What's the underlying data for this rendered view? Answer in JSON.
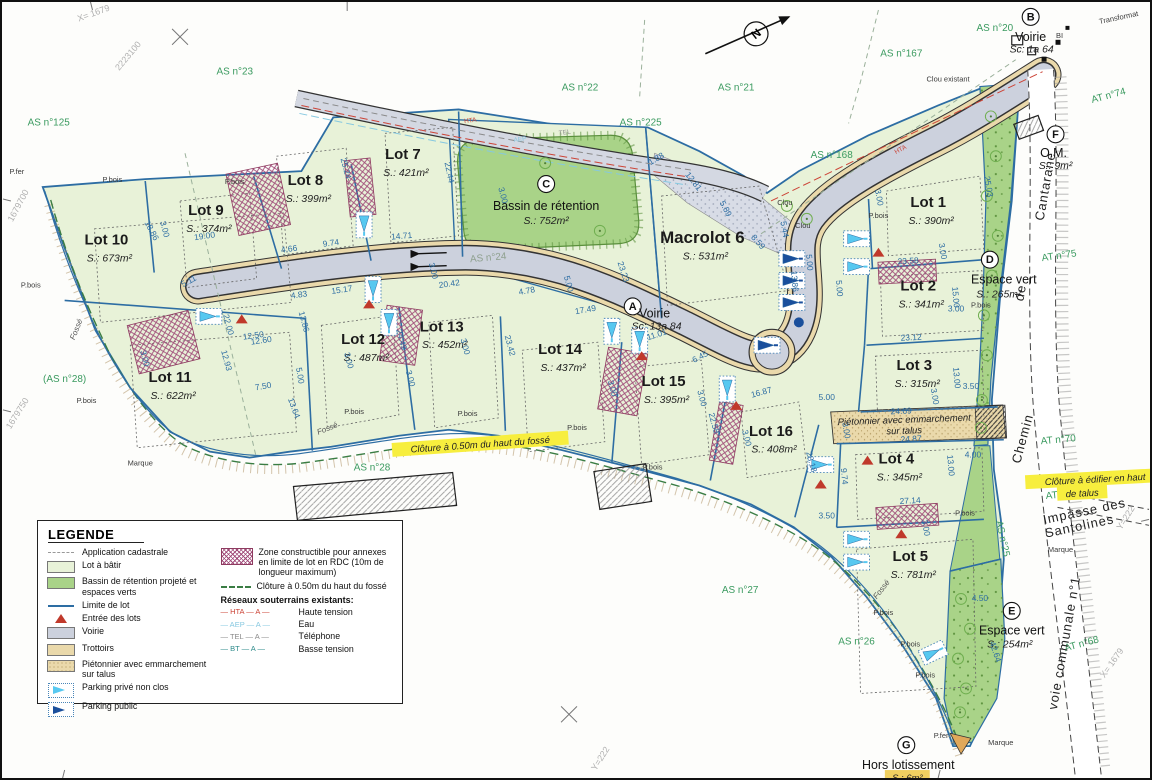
{
  "legend": {
    "title": "LEGENDE",
    "items": [
      {
        "key": "application-cadastrale",
        "swatch": "dash-gray",
        "label": "Application cadastrale"
      },
      {
        "key": "lot-a-batir",
        "swatch": "fill-lightgreen",
        "label": "Lot à bâtir"
      },
      {
        "key": "bassin-espaces-verts",
        "swatch": "fill-green",
        "label": "Bassin de rétention projeté et espaces verts"
      },
      {
        "key": "limite-de-lot",
        "swatch": "line-blue",
        "label": "Limite de lot"
      },
      {
        "key": "entree-des-lots",
        "swatch": "tri-red",
        "label": "Entrée des lots"
      },
      {
        "key": "voirie",
        "swatch": "fill-gray",
        "label": "Voirie"
      },
      {
        "key": "trottoirs",
        "swatch": "fill-tan",
        "label": "Trottoirs"
      },
      {
        "key": "pietonnier",
        "swatch": "fill-tantex",
        "label": "Piétonnier avec emmarchement sur talus"
      },
      {
        "key": "parking-prive",
        "swatch": "park-light",
        "label": "Parking privé non clos"
      },
      {
        "key": "parking-public",
        "swatch": "park-dark",
        "label": "Parking public"
      }
    ],
    "right_items": [
      {
        "key": "zone-constructible",
        "swatch": "hatch-purple",
        "label": "Zone constructible pour annexes en limite de lot en RDC (10m de longueur maximum)"
      },
      {
        "key": "cloture-fosse",
        "swatch": "dash-green",
        "label": "Clôture à 0.50m du haut du fossé"
      }
    ],
    "networks_title": "Réseaux souterrains existants:",
    "networks": [
      {
        "code": "HTA",
        "label": "Haute tension",
        "color": "#cc4437"
      },
      {
        "code": "AEP",
        "label": "Eau",
        "color": "#86c8e0"
      },
      {
        "code": "TEL",
        "label": "Téléphone",
        "color": "#8a8a8a"
      },
      {
        "code": "BT",
        "label": "Basse tension",
        "color": "#2e8b8b"
      }
    ]
  },
  "lots": [
    {
      "name": "Lot 1",
      "area": "S.: 390m²",
      "x": 930,
      "y": 206
    },
    {
      "name": "Lot 2",
      "area": "S.: 341m²",
      "x": 920,
      "y": 290
    },
    {
      "name": "Lot 3",
      "area": "S.: 315m²",
      "x": 916,
      "y": 370
    },
    {
      "name": "Lot 4",
      "area": "S.: 345m²",
      "x": 898,
      "y": 464
    },
    {
      "name": "Lot 5",
      "area": "S.: 781m²",
      "x": 912,
      "y": 562
    },
    {
      "name": "Macrolot 6",
      "area": "S.: 531m²",
      "x": 703,
      "y": 242,
      "big": true
    },
    {
      "name": "Lot 7",
      "area": "S.: 421m²",
      "x": 402,
      "y": 158
    },
    {
      "name": "Lot 8",
      "area": "S.: 399m²",
      "x": 304,
      "y": 184
    },
    {
      "name": "Lot 9",
      "area": "S.: 374m²",
      "x": 204,
      "y": 214
    },
    {
      "name": "Lot 10",
      "area": "S.: 673m²",
      "x": 104,
      "y": 244
    },
    {
      "name": "Lot 11",
      "area": "S.: 622m²",
      "x": 168,
      "y": 382
    },
    {
      "name": "Lot 12",
      "area": "S.: 487m²",
      "x": 362,
      "y": 344
    },
    {
      "name": "Lot 13",
      "area": "S.: 452m²",
      "x": 441,
      "y": 331
    },
    {
      "name": "Lot 14",
      "area": "S.: 437m²",
      "x": 560,
      "y": 354
    },
    {
      "name": "Lot 15",
      "area": "S.: 395m²",
      "x": 664,
      "y": 386
    },
    {
      "name": "Lot 16",
      "area": "S.: 408m²",
      "x": 772,
      "y": 436
    }
  ],
  "features": [
    {
      "letter": "A",
      "x": 633,
      "y": 306,
      "lines": [
        {
          "t": "Voirie",
          "dx": 22,
          "dy": 3,
          "cls": "t-feat"
        },
        {
          "t": "Sc: 13a 84",
          "dx": 24,
          "dy": 15,
          "cls": "t-area"
        }
      ]
    },
    {
      "letter": "B",
      "x": 1033,
      "y": 15,
      "lines": [
        {
          "t": "Voirie",
          "dx": 0,
          "dy": 16,
          "cls": "t-feat"
        },
        {
          "t": "Sc: 1a 64",
          "dx": 1,
          "dy": 28,
          "cls": "t-area"
        }
      ]
    },
    {
      "letter": "C",
      "x": 546,
      "y": 183,
      "lines": [
        {
          "t": "Bassin de rétention",
          "dx": 0,
          "dy": 18,
          "cls": "t-feat"
        },
        {
          "t": "S.: 752m²",
          "dx": 0,
          "dy": 32,
          "cls": "t-area"
        }
      ]
    },
    {
      "letter": "D",
      "x": 992,
      "y": 259,
      "lines": [
        {
          "t": "Espace vert",
          "dx": 14,
          "dy": 16,
          "cls": "t-feat"
        },
        {
          "t": "S.: 265m²",
          "dx": 9,
          "dy": 30,
          "cls": "t-area"
        }
      ]
    },
    {
      "letter": "E",
      "x": 1014,
      "y": 612,
      "lines": [
        {
          "t": "Espace vert",
          "dx": 0,
          "dy": 16,
          "cls": "t-feat"
        },
        {
          "t": "S.: 254m²",
          "dx": -2,
          "dy": 29,
          "cls": "t-area"
        }
      ]
    },
    {
      "letter": "F",
      "x": 1058,
      "y": 133,
      "lines": [
        {
          "t": "O.M.",
          "dx": -2,
          "dy": 15,
          "cls": "t-feat"
        },
        {
          "t": "S.: 9m²",
          "dx": 0,
          "dy": 27,
          "cls": "t-area"
        }
      ]
    },
    {
      "letter": "G",
      "x": 908,
      "y": 747,
      "lines": [
        {
          "t": "Hors lotissement",
          "dx": 2,
          "dy": 16,
          "cls": "t-feat"
        },
        {
          "t": "S.: 6m²",
          "dx": 1,
          "dy": 28,
          "cls": "t-area",
          "hl": "#f0d060"
        }
      ]
    }
  ],
  "parcel_labels": [
    {
      "t": "AS n°125",
      "x": 46,
      "y": 124,
      "r": 0
    },
    {
      "t": "AS n°23",
      "x": 233,
      "y": 73,
      "r": 0
    },
    {
      "t": "AS n°22",
      "x": 580,
      "y": 89,
      "r": 0
    },
    {
      "t": "AS n°21",
      "x": 737,
      "y": 89,
      "r": 0
    },
    {
      "t": "AS n°225",
      "x": 641,
      "y": 124,
      "r": 0
    },
    {
      "t": "AS n°20",
      "x": 997,
      "y": 29,
      "r": 0
    },
    {
      "t": "AS n°167",
      "x": 903,
      "y": 55,
      "r": 0
    },
    {
      "t": "AS n°168",
      "x": 833,
      "y": 157,
      "r": 0
    },
    {
      "t": "AS n°24",
      "x": 488,
      "y": 260,
      "r": -5,
      "gray": true
    },
    {
      "t": "(AS n°28)",
      "x": 62,
      "y": 382,
      "r": 0
    },
    {
      "t": "AS n°28",
      "x": 371,
      "y": 471,
      "r": 0
    },
    {
      "t": "AS n°27",
      "x": 741,
      "y": 594,
      "r": 0
    },
    {
      "t": "AS n°26",
      "x": 858,
      "y": 646,
      "r": 0
    },
    {
      "t": "AS n°25",
      "x": 1002,
      "y": 540,
      "r": 78
    },
    {
      "t": "AT n°75",
      "x": 1062,
      "y": 258,
      "r": -8
    },
    {
      "t": "AT n°74",
      "x": 1112,
      "y": 97,
      "r": -15
    },
    {
      "t": "AT n°70",
      "x": 1061,
      "y": 443,
      "r": -5
    },
    {
      "t": "AT n°69",
      "x": 1066,
      "y": 498,
      "r": -5
    },
    {
      "t": "AT n°68",
      "x": 1085,
      "y": 648,
      "r": -15
    }
  ],
  "street_labels": [
    {
      "t": "Cantarane",
      "x": 1052,
      "y": 186,
      "r": -80,
      "size": 13
    },
    {
      "t": "de",
      "x": 1027,
      "y": 293,
      "r": -80,
      "size": 13
    },
    {
      "t": "Chemin",
      "x": 1029,
      "y": 440,
      "r": -75,
      "size": 13
    },
    {
      "t": "voie communale n°1",
      "x": 1071,
      "y": 645,
      "r": -80,
      "size": 12
    },
    {
      "t": "Impasse des",
      "x": 1088,
      "y": 516,
      "r": -12,
      "size": 9
    },
    {
      "t": "Santolines",
      "x": 1083,
      "y": 531,
      "r": -12,
      "size": 9
    }
  ],
  "notes": [
    {
      "t": "Clôture à 0.50m du haut du fossé",
      "x": 480,
      "y": 448,
      "r": -4,
      "hl": "#f7ee3e"
    },
    {
      "t": "Clôture à édifier en haut",
      "x": 1098,
      "y": 483,
      "r": -3,
      "hl": "#f7ee3e"
    },
    {
      "t": "de talus",
      "x": 1085,
      "y": 497,
      "r": -3,
      "hl": "#f7ee3e"
    },
    {
      "t": "Piétonnier avec emmarchement",
      "x": 906,
      "y": 423,
      "r": -2,
      "hl": null
    },
    {
      "t": "sur talus",
      "x": 906,
      "y": 434,
      "r": -2,
      "hl": null
    }
  ],
  "marker_labels": [
    {
      "t": "P.fer",
      "x": 14,
      "y": 173,
      "r": 0
    },
    {
      "t": "P.fer",
      "x": 943,
      "y": 740,
      "r": 0
    },
    {
      "t": "P.bois",
      "x": 110,
      "y": 181,
      "r": 0
    },
    {
      "t": "P.bois",
      "x": 233,
      "y": 183,
      "r": 0
    },
    {
      "t": "P.bois",
      "x": 28,
      "y": 287,
      "r": 0
    },
    {
      "t": "P.bois",
      "x": 84,
      "y": 403,
      "r": 0
    },
    {
      "t": "P.bois",
      "x": 353,
      "y": 414,
      "r": 0
    },
    {
      "t": "P.bois",
      "x": 467,
      "y": 416,
      "r": 0
    },
    {
      "t": "P.bois",
      "x": 577,
      "y": 430,
      "r": 0
    },
    {
      "t": "P.bois",
      "x": 653,
      "y": 470,
      "r": 0
    },
    {
      "t": "P.bois",
      "x": 885,
      "y": 616,
      "r": 0
    },
    {
      "t": "P.bois",
      "x": 912,
      "y": 648,
      "r": 0
    },
    {
      "t": "P.bois",
      "x": 927,
      "y": 679,
      "r": 0
    },
    {
      "t": "P.bois",
      "x": 983,
      "y": 307,
      "r": 0
    },
    {
      "t": "P.bois",
      "x": 967,
      "y": 516,
      "r": 0
    },
    {
      "t": "P.bois",
      "x": 880,
      "y": 217,
      "r": 0
    },
    {
      "t": "Clou",
      "x": 786,
      "y": 204,
      "r": 0
    },
    {
      "t": "Clou",
      "x": 804,
      "y": 227,
      "r": 0
    },
    {
      "t": "Clou existant",
      "x": 950,
      "y": 80,
      "r": 0
    },
    {
      "t": "Marque",
      "x": 138,
      "y": 466,
      "r": 0
    },
    {
      "t": "Marque",
      "x": 1063,
      "y": 553,
      "r": 0
    },
    {
      "t": "Marque",
      "x": 1003,
      "y": 747,
      "r": 0
    },
    {
      "t": "Transformat",
      "x": 1122,
      "y": 18,
      "r": -12
    },
    {
      "t": "BI",
      "x": 1062,
      "y": 36,
      "r": 0
    }
  ],
  "fosse_labels": [
    {
      "t": "Fossé",
      "x": 327,
      "y": 431,
      "r": -22
    },
    {
      "t": "Fossé",
      "x": 885,
      "y": 592,
      "r": -52
    },
    {
      "t": "Fossé",
      "x": 76,
      "y": 330,
      "r": -68
    }
  ],
  "net_labels": [
    {
      "t": "HTA",
      "x": 470,
      "y": 121,
      "r": -8,
      "c": "#cc4437"
    },
    {
      "t": "AEP",
      "x": 520,
      "y": 140,
      "r": -8,
      "c": "#86c8e0"
    },
    {
      "t": "TEL",
      "x": 565,
      "y": 133,
      "r": -8,
      "c": "#8a8a8a"
    },
    {
      "t": "HTA",
      "x": 903,
      "y": 150,
      "r": -28,
      "c": "#cc4437"
    }
  ],
  "coord_labels": [
    {
      "t": "2223100",
      "x": 128,
      "y": 56,
      "r": -50
    },
    {
      "t": "X= 1679",
      "x": 92,
      "y": 14,
      "r": -20
    },
    {
      "t": "1679700",
      "x": 18,
      "y": 206,
      "r": -62
    },
    {
      "t": "1679750",
      "x": 17,
      "y": 415,
      "r": -58
    },
    {
      "t": "Y=222",
      "x": 603,
      "y": 762,
      "r": -58
    },
    {
      "t": "X= 1679",
      "x": 1117,
      "y": 666,
      "r": -55
    },
    {
      "t": "Y=222",
      "x": 1131,
      "y": 520,
      "r": -58
    }
  ],
  "north_label": "N",
  "dims": [
    [
      "19.00",
      203,
      238,
      -8
    ],
    [
      "18.86",
      147,
      231,
      62
    ],
    [
      "25.24",
      342,
      168,
      75
    ],
    [
      "14.71",
      401,
      238,
      -5
    ],
    [
      "9.74",
      330,
      245,
      -8
    ],
    [
      "4.66",
      288,
      251,
      -8
    ],
    [
      "5.11",
      188,
      283,
      -28
    ],
    [
      "4.83",
      298,
      297,
      -8
    ],
    [
      "15.17",
      341,
      292,
      -8
    ],
    [
      "20.42",
      449,
      286,
      -8
    ],
    [
      "22.44",
      446,
      172,
      78
    ],
    [
      "17.49",
      586,
      312,
      -10
    ],
    [
      "4.78",
      527,
      293,
      -10
    ],
    [
      "5.00",
      566,
      284,
      75
    ],
    [
      "23.23",
      621,
      272,
      72
    ],
    [
      "12.81",
      692,
      182,
      52
    ],
    [
      "1.88",
      658,
      160,
      -30
    ],
    [
      "5.89",
      724,
      209,
      62
    ],
    [
      "8.59",
      757,
      243,
      48
    ],
    [
      "5.44",
      783,
      229,
      80
    ],
    [
      "13.86",
      793,
      281,
      85
    ],
    [
      "5.00",
      838,
      288,
      85
    ],
    [
      "5.00",
      808,
      262,
      85
    ],
    [
      "12.60",
      260,
      343,
      -8
    ],
    [
      "22.00",
      224,
      325,
      75
    ],
    [
      "12.93",
      222,
      361,
      75
    ],
    [
      "7.50",
      262,
      389,
      -10
    ],
    [
      "13.64",
      290,
      409,
      70
    ],
    [
      "13.86",
      300,
      322,
      75
    ],
    [
      "5.00",
      296,
      376,
      80
    ],
    [
      "24.49",
      398,
      340,
      75
    ],
    [
      "23.42",
      507,
      346,
      75
    ],
    [
      "11.01",
      658,
      337,
      -18
    ],
    [
      "6.45",
      702,
      359,
      -28
    ],
    [
      "16.87",
      763,
      395,
      -15
    ],
    [
      "22.58",
      712,
      424,
      75
    ],
    [
      "28.18",
      810,
      463,
      75
    ],
    [
      "5.00",
      828,
      400,
      0
    ],
    [
      "24.69",
      903,
      414,
      -3
    ],
    [
      "24.87",
      913,
      442,
      -3
    ],
    [
      "27.14",
      912,
      504,
      -3
    ],
    [
      "13.00",
      950,
      466,
      85
    ],
    [
      "4.00",
      975,
      458,
      0
    ],
    [
      "9.74",
      843,
      477,
      85
    ],
    [
      "3.50",
      828,
      519,
      0
    ],
    [
      "4.50",
      982,
      602,
      0
    ],
    [
      "42.64",
      995,
      654,
      72
    ],
    [
      "25.03",
      988,
      186,
      80
    ],
    [
      "23.12",
      913,
      340,
      -3
    ],
    [
      "15.00",
      955,
      297,
      85
    ],
    [
      "23.58",
      910,
      263,
      -3
    ],
    [
      "13.00",
      956,
      378,
      85
    ],
    [
      "3.50",
      973,
      389,
      0
    ],
    [
      "12.50",
      252,
      338,
      -8
    ],
    [
      "3.00",
      160,
      229,
      75
    ],
    [
      "3.00",
      140,
      359,
      75
    ],
    [
      "3.00",
      345,
      361,
      75
    ],
    [
      "3.00",
      407,
      379,
      75
    ],
    [
      "3.00",
      430,
      271,
      75
    ],
    [
      "3.00",
      500,
      195,
      75
    ],
    [
      "3.00",
      878,
      197,
      80
    ],
    [
      "3.00",
      942,
      251,
      80
    ],
    [
      "3.00",
      958,
      311,
      0
    ],
    [
      "3.00",
      934,
      397,
      80
    ],
    [
      "3.00",
      845,
      431,
      80
    ],
    [
      "3.00",
      925,
      529,
      80
    ],
    [
      "3.00",
      700,
      399,
      75
    ],
    [
      "3.00",
      745,
      439,
      75
    ],
    [
      "3.00",
      610,
      389,
      75
    ],
    [
      "3.00",
      462,
      347,
      75
    ]
  ]
}
